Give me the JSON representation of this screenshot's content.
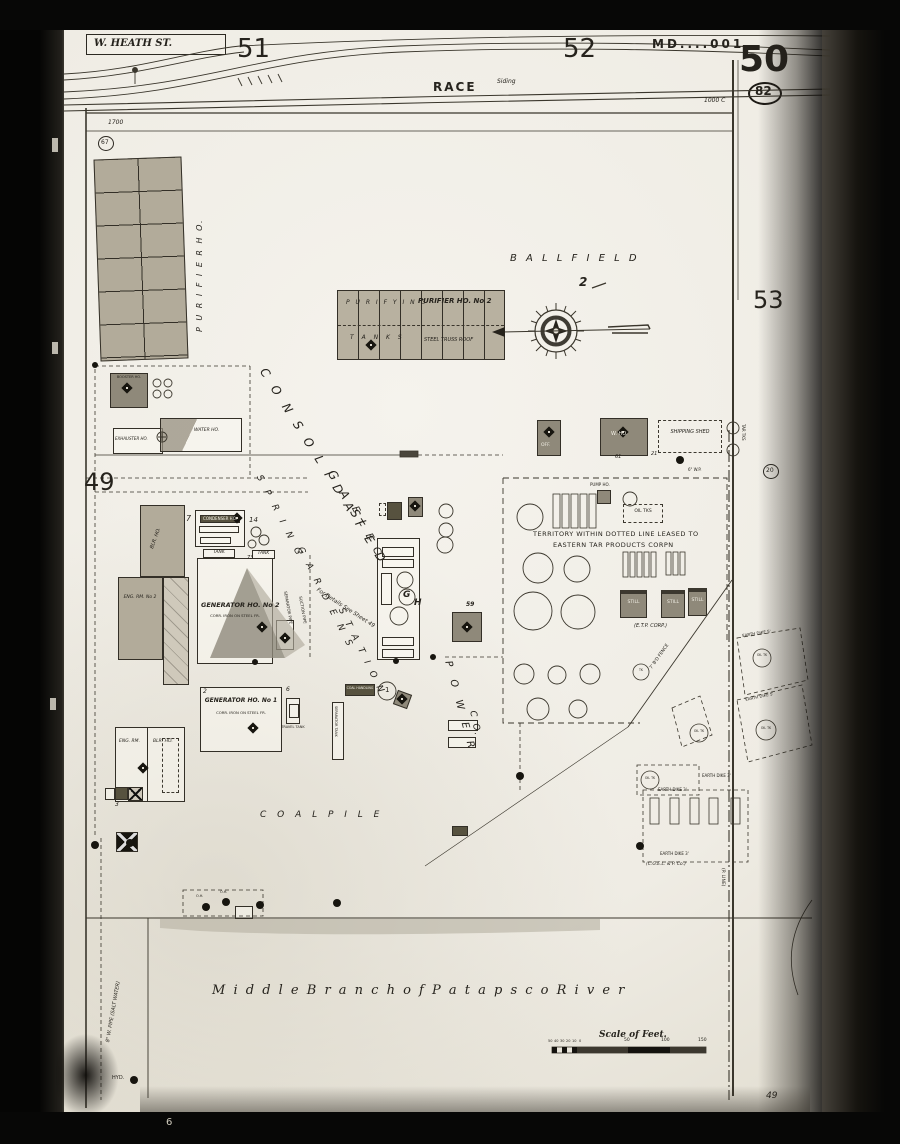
{
  "header": {
    "heath_st": "W. HEATH ST.",
    "sheet_51": "51",
    "sheet_52": "52",
    "stamp": "MD....001",
    "sheet_50": "50",
    "circ_82": "82",
    "sheet_53": "53",
    "sheet_49": "49",
    "race": "RACE",
    "siding": "Siding",
    "ref_1000c": "1000 C",
    "ref_1700": "1700",
    "circ_67": "67",
    "circ_20": "20",
    "film_mark": "6",
    "corner_note": "49"
  },
  "company": {
    "consolidated": "C O N S O L I D A T E D",
    "gas": "G A S",
    "elec": "E L E C.",
    "spring": "S P R I N G",
    "gardens": "G A R D E N S",
    "station": "S T A T I O N",
    "power": "P O W E R",
    "co": "C O."
  },
  "landmarks": {
    "ball_field": "B A L L      F I E L D",
    "flag_2": "2",
    "coal_pile": "C O A L       P I L E",
    "river": "M i d d l e    B r a n c h    o f    P a t a p s c o    R i v e r"
  },
  "buildings": {
    "purifier_ho": "P U R I F I E R    H O.",
    "purifying": "P U R I F Y I N G",
    "purifier_no2": "PURIFIER HO. No 2",
    "tanks": "T A N K S",
    "steel_truss": "STEEL TRUSS ROOF",
    "booster": "BOOSTER HO.",
    "exhauster": "EXHAUSTER HO.",
    "water_ho": "WATER HO.",
    "blr_ho": "BLR. HO.",
    "eng_rm_no2": "ENG. RM. No 2",
    "generator_no2": "GENERATOR HO. No 2",
    "generator_sub": "CORR. IRON ON STEEL FR.",
    "condenser": "CONDENSER HO.",
    "tank": "TANK",
    "generator_no1": "GENERATOR HO. No 1",
    "eng_rm": "ENG. RM.",
    "blr_ho2": "BLR. HO.",
    "travel_tank": "TRAVEL TANK",
    "coal_handling": "COAL HANDLING",
    "sep_tank": "SEPARATOR TANK",
    "g_letter": "G",
    "h_letter": "H",
    "off": "OFF.",
    "w_ho": "W. HO.",
    "shipping_shed": "SHIPPING SHED",
    "separator_pipe": "SEPARATOR PIPE",
    "suction_pipe": "SUCTION PIPE",
    "one": "1"
  },
  "territory": {
    "line1": "TERRITORY WITHIN DOTTED LINE LEASED TO",
    "line2": "EASTERN TAR PRODUCTS CORPN",
    "etp": "(E.T.P. CORP.)",
    "still": "STILL",
    "pump": "PUMP HO.",
    "tar_tks": "TAR TKS",
    "oil_tks": "OIL TKS"
  },
  "dikes": {
    "earth_dike_5": "EARTH DIKE 5'",
    "earth_dike_3": "EARTH DIKE 3'",
    "oil_tk": "OIL TK",
    "tk": "TK",
    "cgelp": "(C.G.E.L. & P. Co.)",
    "p_line": "(P. LINE)",
    "fence_7bd": "7' B'D FENCE"
  },
  "annotations": {
    "for_details": "For Details See Sheet 49",
    "salt_pipe": "8\" W. PIPE (SALT WATER)",
    "hyd": "HYD.",
    "oh": "O.H.",
    "wp": "6\" W.P.",
    "n59": "59",
    "n73": "73",
    "n7": "7",
    "n14": "14",
    "n6": "6",
    "n2": "2",
    "n21": "21",
    "n61": "61",
    "n3": "3"
  },
  "scale": {
    "title": "Scale of Feet.",
    "ticks_small": [
      "50",
      "40",
      "30",
      "20",
      "10",
      "0"
    ],
    "ticks_big": [
      "50",
      "100",
      "150"
    ]
  }
}
